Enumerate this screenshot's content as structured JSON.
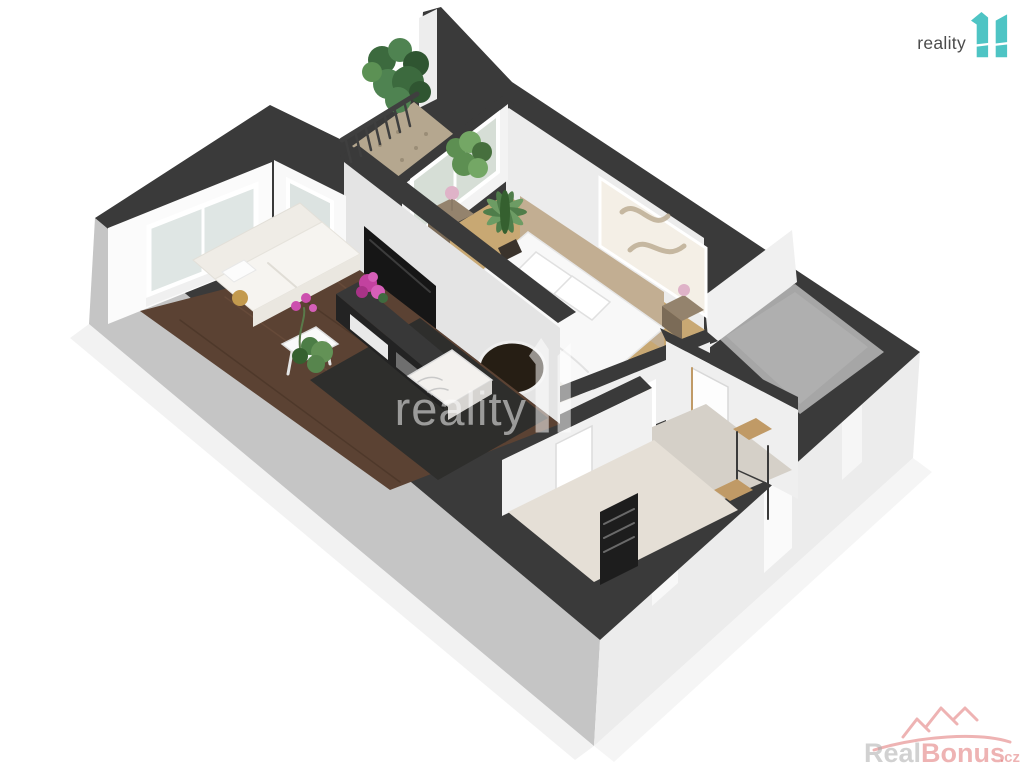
{
  "page": {
    "background": "#ffffff",
    "content_type": "3D floor plan render"
  },
  "branding": {
    "header_logo": {
      "text": "reality",
      "glyph": "11"
    },
    "center_watermark": {
      "text": "reality",
      "glyph": "11"
    },
    "corner_watermark": {
      "text_primary": "Real",
      "text_accent": "Bonus",
      "suffix": ".cz"
    }
  },
  "palette": {
    "logo_text": "#4b4b4b",
    "logo_teal": "#4ec4c4",
    "watermark_white": "rgba(255,255,255,0.52)",
    "watermark_gray": "rgba(172,172,172,0.55)",
    "watermark_red": "rgba(224,116,116,0.55)",
    "wall_top": "#3a3a3a",
    "wall_ext_sw": "#c5c5c5",
    "wall_ext_se": "#ececec",
    "wall_int": "#f1f1f1",
    "floor_wood": "#5b4233",
    "rug": "#2e2e2c",
    "floor_bedroom": "#c8a873",
    "floor_hall": "#d5d0c8",
    "floor_bath": "#e5dfd6",
    "floor_room": "#a6a6a6",
    "balcony_floor": "#b5a78f",
    "plant": "#4f7d4a",
    "flower": "#c2429f",
    "glass": "#dce3e1",
    "bed_white": "#f8f8f8",
    "headboard": "#c2ae92",
    "furniture_dark": "#2b2b2b",
    "wood_accent": "#c09a66"
  }
}
